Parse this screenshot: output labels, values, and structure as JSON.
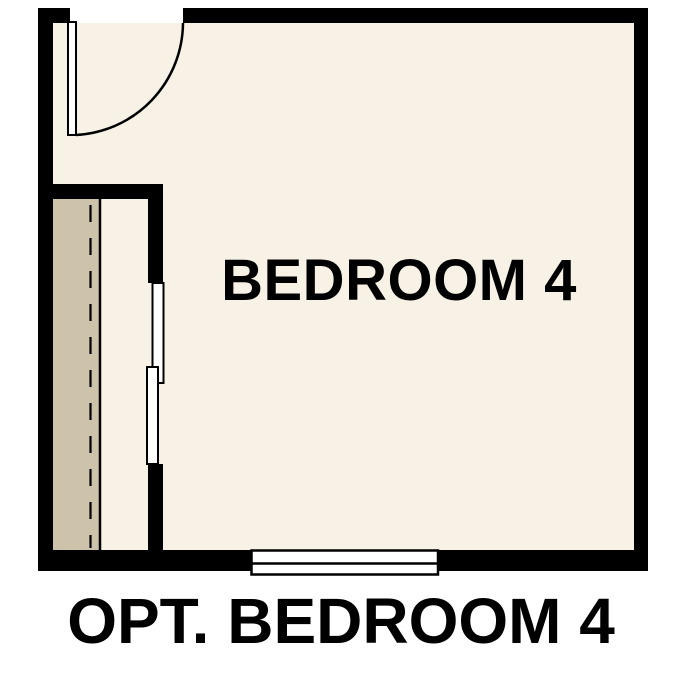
{
  "plan": {
    "room_label": "BEDROOM 4",
    "caption": "OPT. BEDROOM 4"
  },
  "colors": {
    "background": "#ffffff",
    "floor": "#f8f1e5",
    "closet_floor": "#cdc3ab",
    "wall": "#000000",
    "door_fill": "#ffffff",
    "label_text": "#000000"
  }
}
